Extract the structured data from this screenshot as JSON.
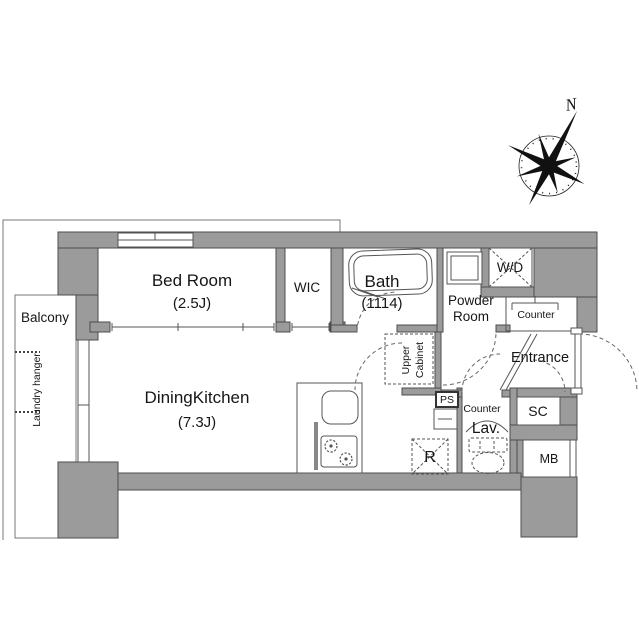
{
  "compass": {
    "north_label": "N"
  },
  "rooms": {
    "bed_room": {
      "name": "Bed Room",
      "size": "(2.5J)"
    },
    "wic": {
      "name": "WIC"
    },
    "bath": {
      "name": "Bath",
      "size": "(1114)"
    },
    "powder_room": {
      "line1": "Powder",
      "line2": "Room"
    },
    "dining_kitchen": {
      "name": "DiningKitchen",
      "size": "(7.3J)"
    },
    "entrance": {
      "name": "Entrance"
    },
    "balcony": {
      "name": "Balcony"
    },
    "lav": {
      "name": "Lav.",
      "counter": "Counter"
    }
  },
  "features": {
    "wd": "W/D",
    "counter": "Counter",
    "sc": "SC",
    "mb": "MB",
    "ps": "PS",
    "refrigerator": "R",
    "upper_cabinet_line1": "Upper",
    "upper_cabinet_line2": "Cabinet",
    "laundry_hanger": "Laundry hanger"
  },
  "colors": {
    "wall_fill": "#9b9b9b",
    "wall_stroke": "#4d4d4d",
    "dash_line": "#666666"
  }
}
